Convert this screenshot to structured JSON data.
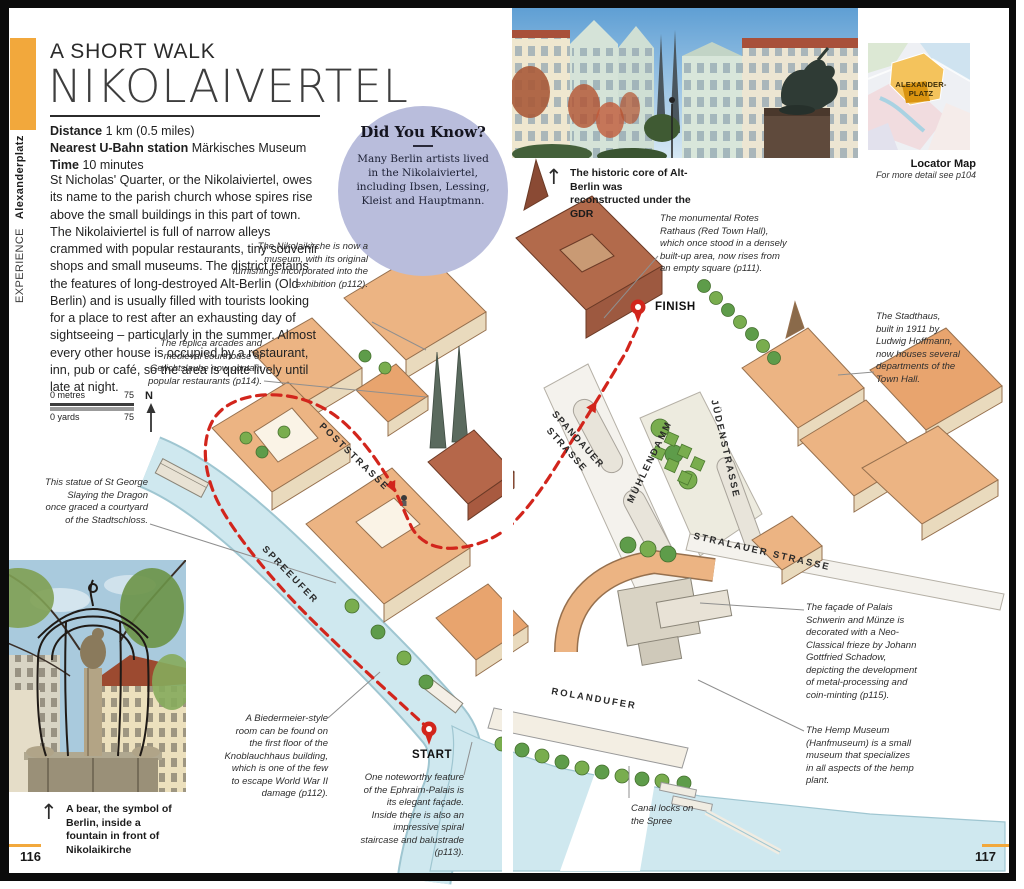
{
  "page": {
    "left_page_number": "116",
    "right_page_number": "117",
    "sidebar": {
      "experience_label": "EXPERIENCE",
      "section_label": "Alexanderplatz"
    },
    "header": {
      "kicker": "A SHORT WALK",
      "title": "NIKOLAIVERTEL"
    },
    "info": {
      "distance_label": "Distance",
      "distance_value": "1 km (0.5 miles)",
      "station_label": "Nearest U-Bahn station",
      "station_value": "Märkisches Museum",
      "time_label": "Time",
      "time_value": "10 minutes"
    },
    "intro": "St Nicholas' Quarter, or the Nikolaiviertel, owes its name to the parish church whose spires rise above the small buildings in this part of town. The Nikolaiviertel is full of narrow alleys crammed with popular restaurants, tiny souvenir shops and small museums. The district retains the features of long-destroyed Alt-Berlin (Old Berlin) and is usually filled with tourists looking for a place to rest after an exhausting day of sightseeing – particularly in the summer. Almost every other house is occupied by a restaurant, inn, pub or café, so the area is quite lively until late at night.",
    "did_you_know": {
      "title": "Did You Know?",
      "body": "Many Berlin artists lived in the Nikolaiviertel, including Ibsen, Lessing, Kleist and Hauptmann."
    },
    "captions": {
      "top_photo": "The historic core of Alt-Berlin was reconstructed under the GDR",
      "bottom_photo": "A bear, the symbol of Berlin, inside a fountain in front of Nikolaikirche"
    },
    "locator": {
      "area_label": "ALEXANDER-\nPLATZ",
      "title": "Locator Map",
      "subtitle": "For more detail see p104"
    },
    "scale": {
      "metres_start": "0 metres",
      "metres_end": "75",
      "yards_start": "0 yards",
      "yards_end": "75",
      "north_label": "N"
    },
    "map": {
      "start_label": "START",
      "finish_label": "FINISH",
      "streets": [
        "POSTSTRASSE",
        "SPREEUFER",
        "SPANDAUER\nSTRASSE",
        "MÜHLENDAMM",
        "JÜDENSTRASSE",
        "STRALAUER STRASSE",
        "ROLANDUFER"
      ],
      "annotations": [
        "The Nikolaikirche is now a museum, with its original furnishings incorporated into the exhibition (p112).",
        "The replica arcades and medieval courthouse of Gerichtslaube now contain popular restaurants (p114).",
        "This statue of St George Slaying the Dragon once graced a courtyard of the Stadtschloss.",
        "The monumental Rotes Rathaus (Red Town Hall), which once stood in a densely built-up area, now rises from an empty square (p111).",
        "The Stadthaus, built in 1911 by Ludwig Hoffmann, now houses several departments of the Town Hall.",
        "The façade of Palais Schwerin and Münze is decorated with a Neo-Classical frieze by Johann Gottfried Schadow, depicting the development of metal-processing and coin-minting (p115).",
        "The Hemp Museum (Hanfmuseum) is a small museum that specializes in all aspects of the hemp plant.",
        "A Biedermeier-style room can be found on the first floor of the Knoblauchhaus building, which is one of the few to escape World War II damage (p112).",
        "One noteworthy feature of the Ephraim-Palais is its elegant façade. Inside there is also an impressive spiral staircase and balustrade (p113).",
        "Canal locks on the Spree"
      ]
    },
    "colors": {
      "accent_orange": "#F2A83C",
      "route_red": "#D2251C",
      "bubble_lavender": "#B9BDDC",
      "water_blue": "#CFE8EF"
    }
  }
}
